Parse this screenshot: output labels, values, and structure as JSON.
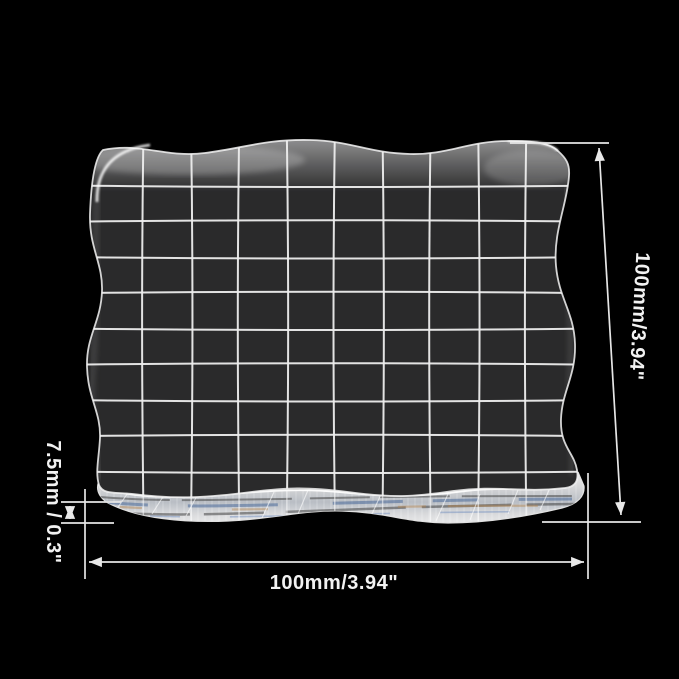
{
  "diagram": {
    "type": "product-dimension-diagram",
    "subject": "clear acrylic stamp block with alignment grid",
    "background_color": "#000000",
    "block": {
      "grid_rows": 10,
      "grid_cols": 10,
      "face_color": "#2a2a2b",
      "grid_line_color": "#ededed",
      "edge_highlight_color": "#f5f5f5",
      "side_edge_tint_blue": "#3e5f94",
      "side_edge_tint_tan": "#b5854e"
    },
    "dimensions": {
      "height_label": "100mm/3.94\"",
      "width_label": "100mm/3.94\"",
      "thickness_label": "7.5mm / 0.3\"",
      "annotation_color": "#e6e6e6",
      "label_color": "#f2f2f2"
    }
  }
}
